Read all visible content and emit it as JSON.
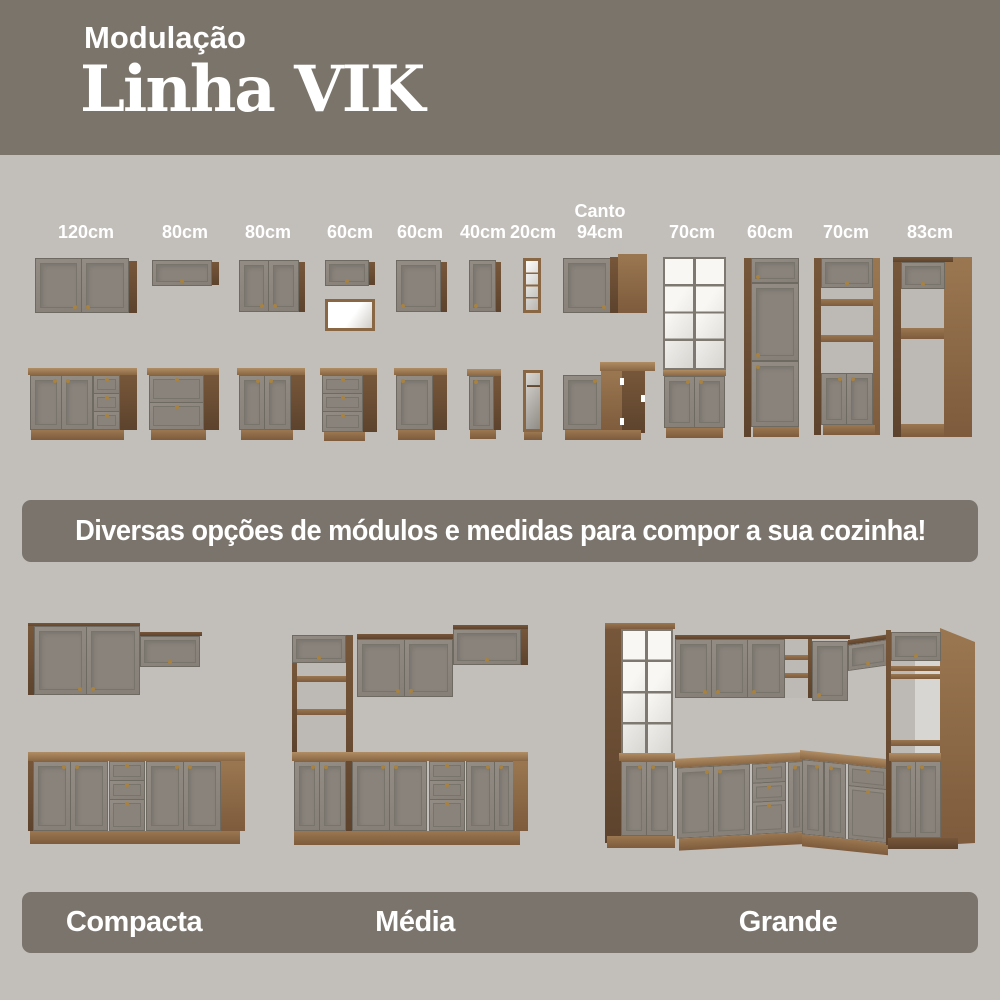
{
  "header": {
    "subtitle": "Modulação",
    "title": "Linha VIK"
  },
  "modules": {
    "labels": [
      "120cm",
      "80cm",
      "80cm",
      "60cm",
      "60cm",
      "40cm",
      "20cm",
      "Canto\n94cm",
      "70cm",
      "60cm",
      "70cm",
      "83cm"
    ]
  },
  "banner": {
    "text": "Diversas opções de módulos e medidas para compor a sua cozinha!"
  },
  "kitchens": {
    "sizes": [
      "Compacta",
      "Média",
      "Grande"
    ]
  },
  "colors": {
    "page_bg": "#c2bfba",
    "header_bg": "#7b746b",
    "banner_bg": "#7a746c",
    "cabinet_door": "#8a847b",
    "wood": "#8a6744",
    "wood_dark": "#5d432d",
    "countertop": "#b08d63",
    "interior_white": "#f2f1ed",
    "knob_brass": "#a8823e",
    "text": "#ffffff"
  }
}
